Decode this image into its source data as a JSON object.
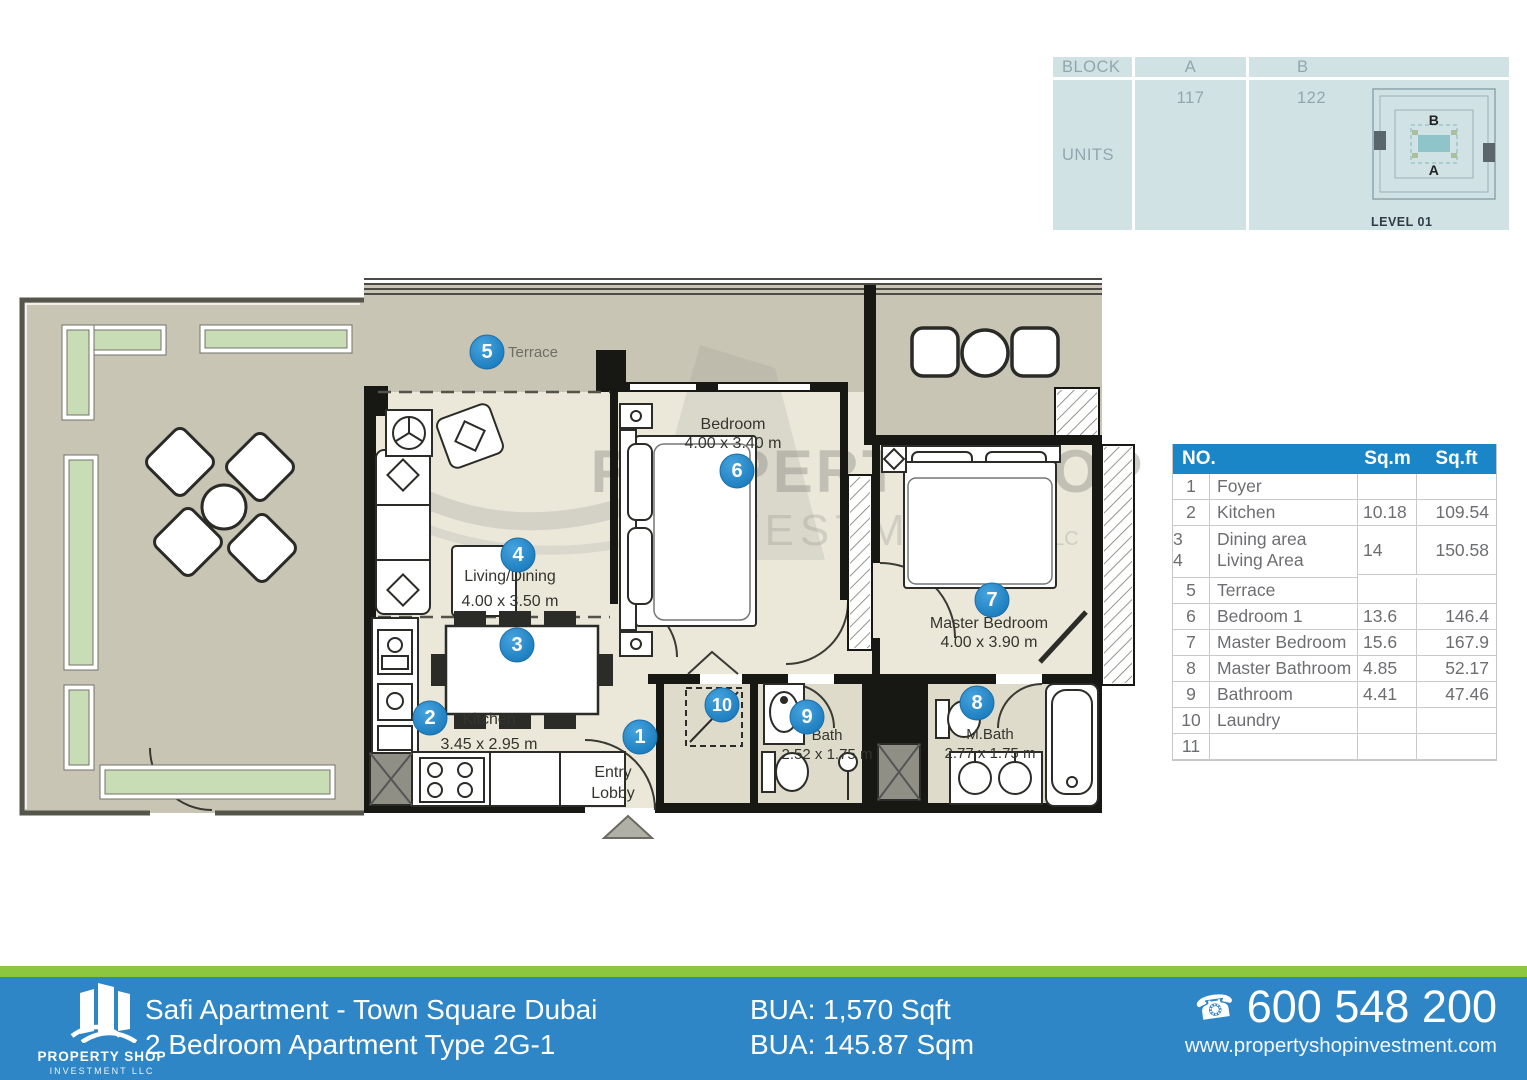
{
  "units_table": {
    "col_block": "BLOCK",
    "col_a": "A",
    "col_b": "B",
    "row_units": "UNITS",
    "units_a": "117",
    "units_b": "122",
    "plan_a": "A",
    "plan_b": "B",
    "level_label": "LEVEL 01"
  },
  "area_table": {
    "header_no": "NO.",
    "header_sqm": "Sq.m",
    "header_sqft": "Sq.ft",
    "rows": [
      {
        "no": "1",
        "name": "Foyer",
        "sqm": "",
        "sqft": ""
      },
      {
        "no": "2",
        "name": "Kitchen",
        "sqm": "10.18",
        "sqft": "109.54"
      },
      {
        "no": "3|4",
        "name": "Dining area|Living Area",
        "sqm": "14",
        "sqft": "150.58",
        "tall": true
      },
      {
        "no": "5",
        "name": "Terrace",
        "sqm": "",
        "sqft": ""
      },
      {
        "no": "6",
        "name": "Bedroom 1",
        "sqm": "13.6",
        "sqft": "146.4"
      },
      {
        "no": "7",
        "name": "Master Bedroom",
        "sqm": "15.6",
        "sqft": "167.9"
      },
      {
        "no": "8",
        "name": "Master Bathroom",
        "sqm": "4.85",
        "sqft": "52.17"
      },
      {
        "no": "9",
        "name": "Bathroom",
        "sqm": "4.41",
        "sqft": "47.46"
      },
      {
        "no": "10",
        "name": "Laundry",
        "sqm": "",
        "sqft": ""
      },
      {
        "no": "11",
        "name": "",
        "sqm": "",
        "sqft": ""
      }
    ]
  },
  "floorplan": {
    "watermark": [
      "PROPERTY SHOP",
      "INVESTMENT",
      "LLC"
    ],
    "markers": [
      {
        "n": "1",
        "x": 640,
        "y": 737
      },
      {
        "n": "2",
        "x": 430,
        "y": 718
      },
      {
        "n": "3",
        "x": 517,
        "y": 645
      },
      {
        "n": "4",
        "x": 518,
        "y": 555
      },
      {
        "n": "5",
        "x": 487,
        "y": 352
      },
      {
        "n": "6",
        "x": 737,
        "y": 471
      },
      {
        "n": "7",
        "x": 992,
        "y": 600
      },
      {
        "n": "8",
        "x": 977,
        "y": 703
      },
      {
        "n": "9",
        "x": 807,
        "y": 717
      },
      {
        "n": "10",
        "x": 722,
        "y": 705
      }
    ],
    "labels": [
      {
        "x": 508,
        "y": 357,
        "anchor": "start",
        "size": 15,
        "color": "#6e6e65",
        "sp": 19,
        "lines": [
          "Terrace"
        ]
      },
      {
        "x": 510,
        "y": 581,
        "size": 16,
        "sp": 25,
        "lines": [
          "Living/Dining",
          "4.00 x 3.50 m"
        ]
      },
      {
        "x": 489,
        "y": 724,
        "size": 16,
        "sp": 25,
        "lines": [
          "Kitchen",
          "3.45 x 2.95 m"
        ]
      },
      {
        "x": 613,
        "y": 777,
        "size": 16,
        "sp": 21,
        "lines": [
          "Entry",
          "Lobby"
        ]
      },
      {
        "x": 733,
        "y": 429,
        "size": 16,
        "sp": 19,
        "lines": [
          "Bedroom",
          "4.00 x 3.40 m"
        ]
      },
      {
        "x": 989,
        "y": 628,
        "size": 16,
        "sp": 19,
        "lines": [
          "Master Bedroom",
          "4.00 x 3.90 m"
        ]
      },
      {
        "x": 827,
        "y": 740,
        "size": 15,
        "sp": 19,
        "lines": [
          "Bath",
          "2.52 x 1.75 m"
        ]
      },
      {
        "x": 990,
        "y": 739,
        "size": 15,
        "sp": 19,
        "lines": [
          "M.Bath",
          "2.77 x 1.75 m"
        ]
      }
    ],
    "marker_color": "#1e87c8"
  },
  "footer": {
    "brand_line1": "PROPERTY SHOP",
    "brand_line2": "INVESTMENT LLC",
    "title_line1": "Safi Apartment - Town Square Dubai",
    "title_line2": "2 Bedroom Apartment Type 2G-1",
    "bua_line1": "BUA: 1,570 Sqft",
    "bua_line2": "BUA: 145.87 Sqm",
    "phone_icon": "☎",
    "phone": "600 548 200",
    "website": "www.propertyshopinvestment.com",
    "colors": {
      "bar": "#2e86c7",
      "strip": "#8dc63f",
      "table_header": "#1a86c8"
    }
  }
}
